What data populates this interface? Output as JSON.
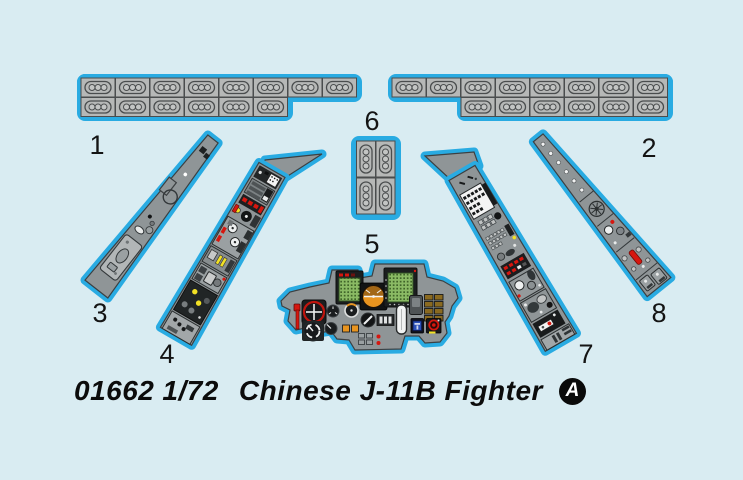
{
  "sheet": {
    "kit_number": "01662",
    "scale": "1/72",
    "kit_name": "Chinese J-11B Fighter",
    "sprue_letter": "A"
  },
  "part_labels": {
    "p1": "1",
    "p2": "2",
    "p3": "3",
    "p4": "4",
    "p5": "5",
    "p6": "6",
    "p7": "7",
    "p8": "8"
  },
  "colors": {
    "bg": "#d9ecf2",
    "accent-blue": "#29abe2",
    "part-gray": "#8f9597",
    "cell-gray": "#b6b8b7",
    "outline-dark": "#3c4042",
    "detail-red": "#d6170f",
    "detail-yellow": "#f2e125",
    "detail-amber": "#e8941f",
    "screen-green": "#8aba64",
    "detail-blue": "#2a50b8",
    "detail-brown": "#8a6a20"
  }
}
